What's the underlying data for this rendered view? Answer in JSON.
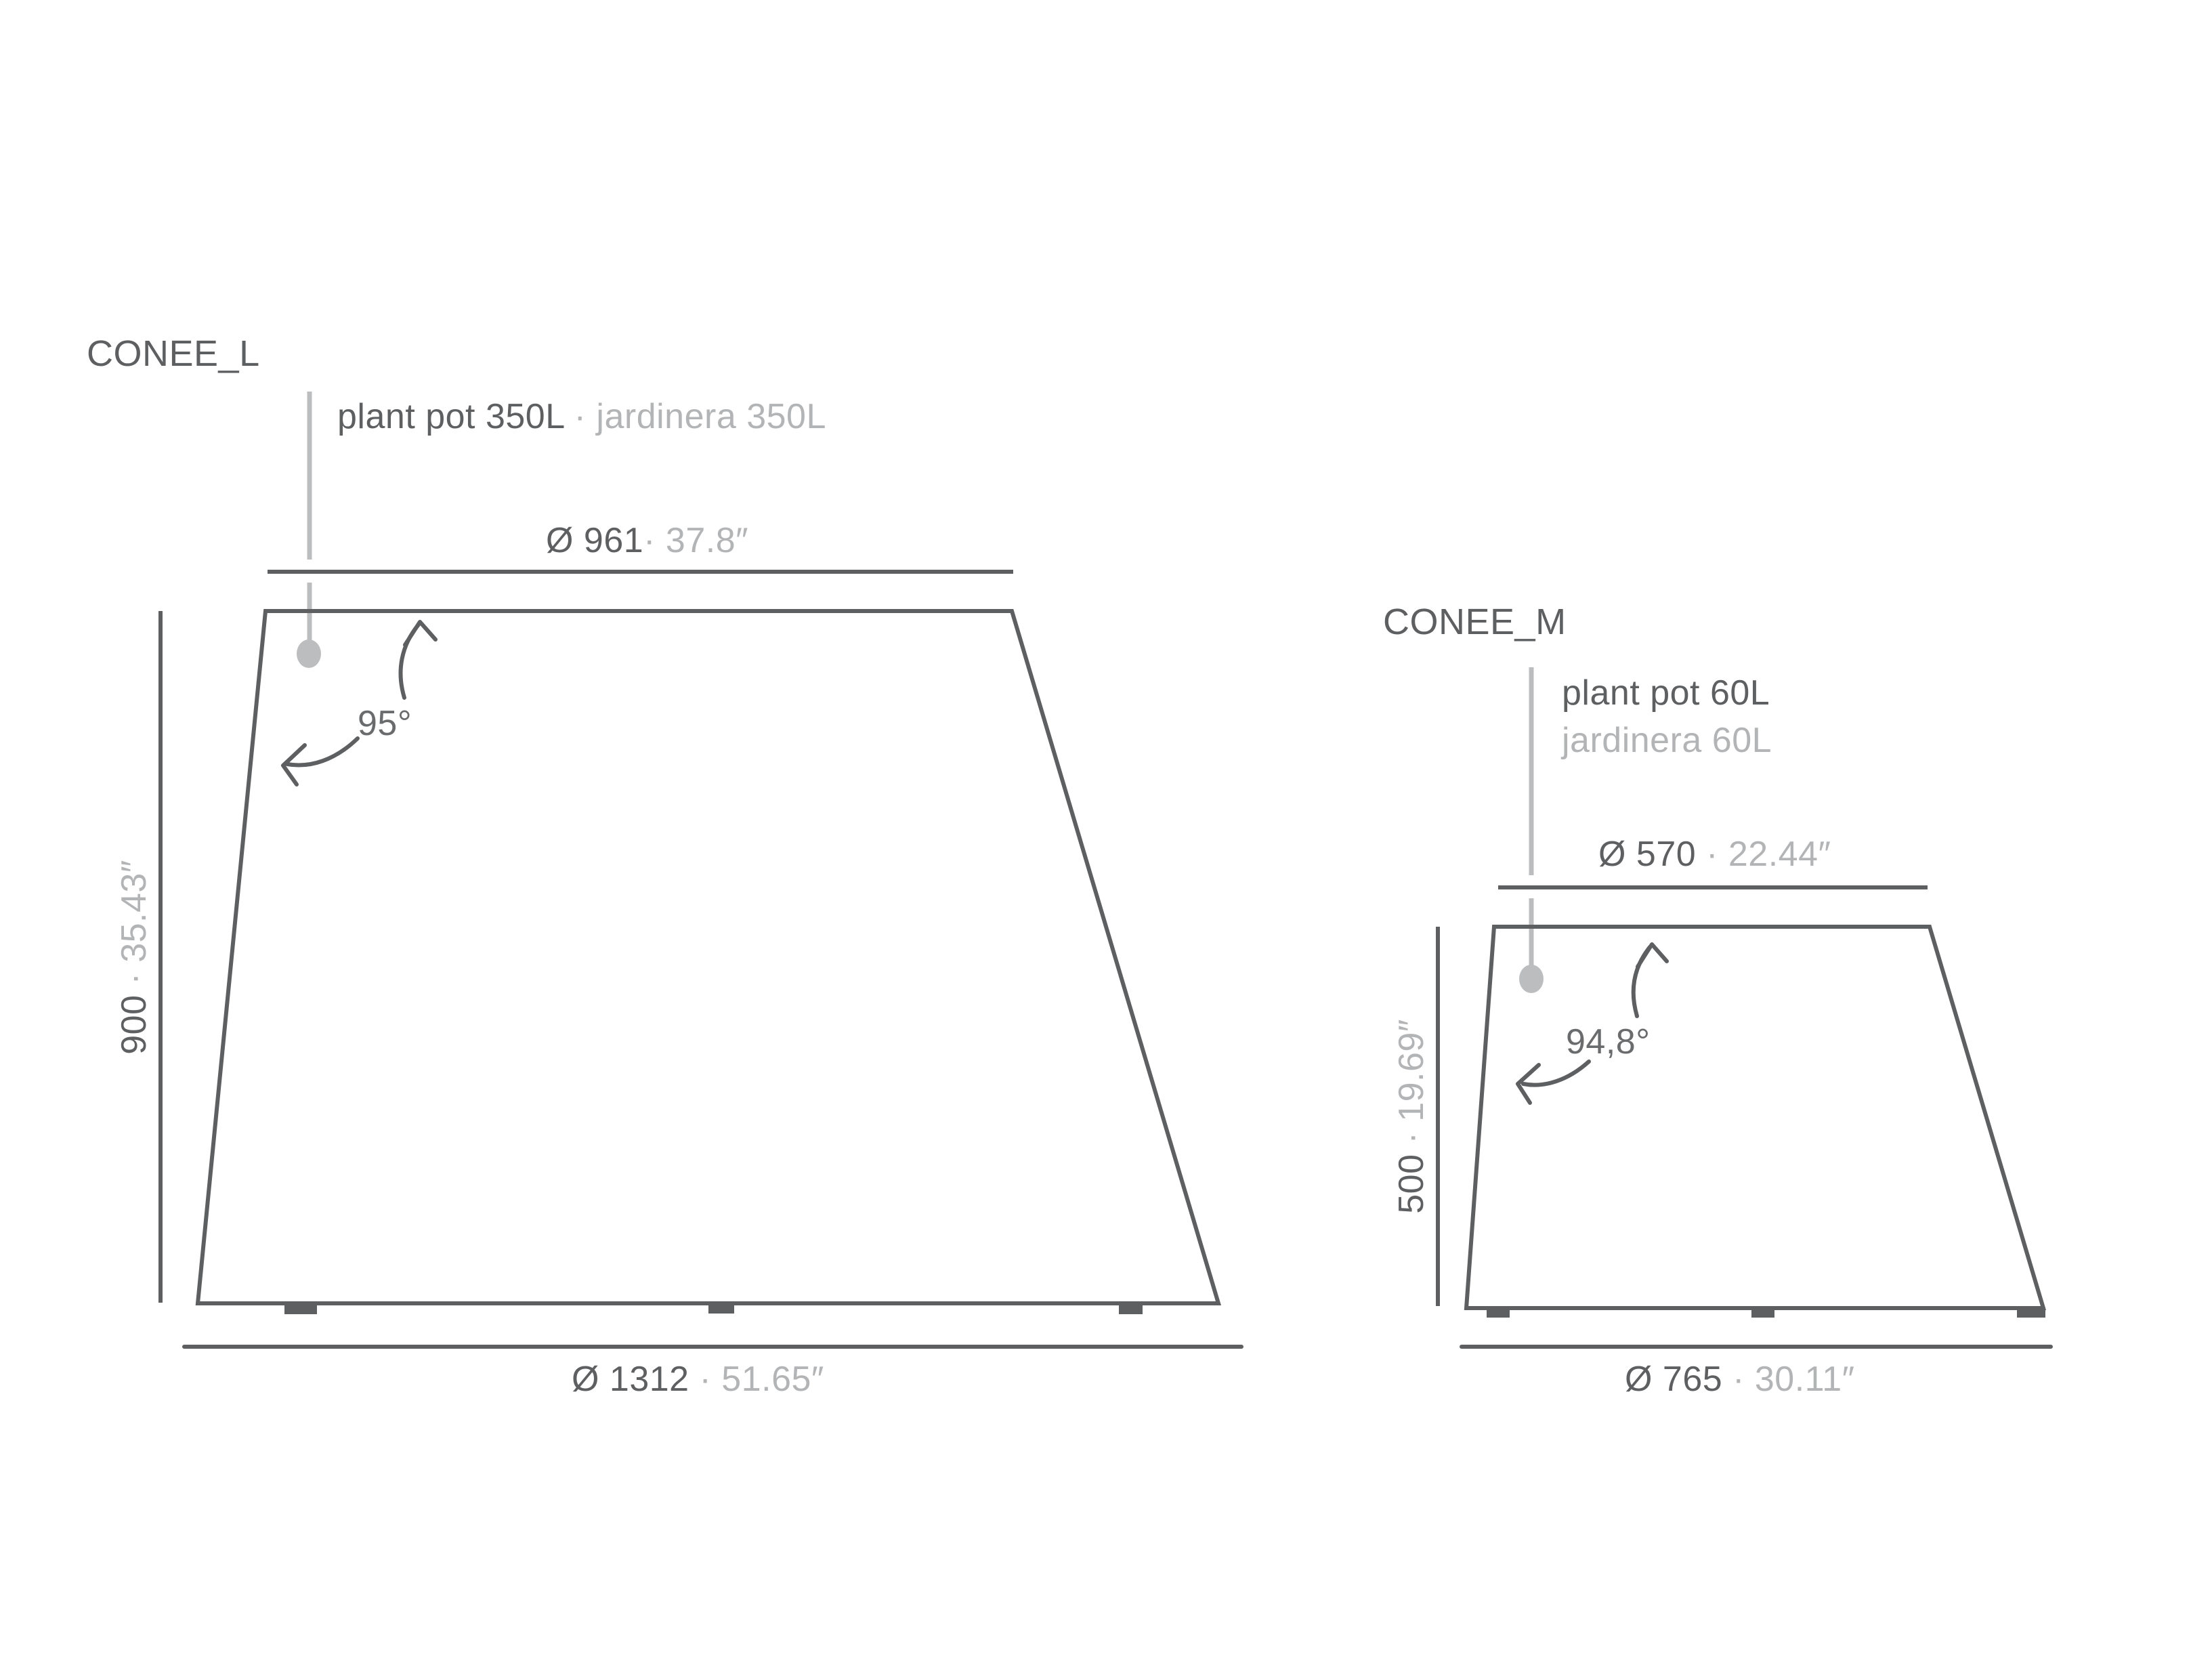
{
  "colors": {
    "line": "#5e5f61",
    "text_primary": "#5e5f61",
    "text_secondary": "#b3b4b6",
    "leader": "#bcbdbf"
  },
  "pots": [
    {
      "name": "CONEE_L",
      "label_primary": "plant pot 350L",
      "label_secondary": " · jardinera 350L",
      "top_diameter_mm": "Ø 961",
      "top_diameter_in": "· 37.8″",
      "height_mm": "900",
      "height_in": " · 35.43″",
      "bottom_diameter_mm": "Ø 1312",
      "bottom_diameter_in": " · 51.65″",
      "angle": "95°"
    },
    {
      "name": "CONEE_M",
      "label_primary": "plant pot 60L",
      "label_secondary": "jardinera 60L",
      "top_diameter_mm": "Ø 570",
      "top_diameter_in": " · 22.44″",
      "height_mm": "500",
      "height_in": " · 19.69″",
      "bottom_diameter_mm": "Ø 765",
      "bottom_diameter_in": " · 30.11″",
      "angle": "94,8°"
    }
  ]
}
